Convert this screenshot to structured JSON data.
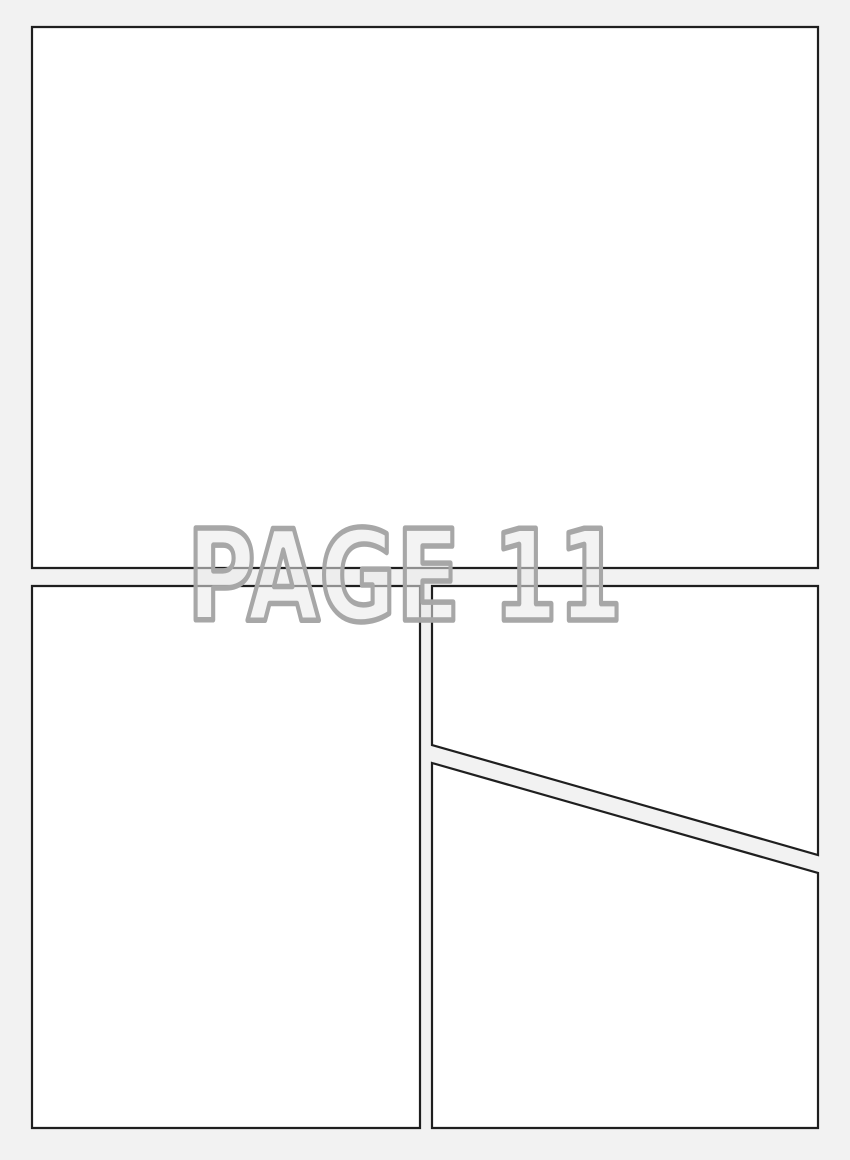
{
  "page_label": {
    "text": "PAGE 11"
  },
  "colors": {
    "page-bg": "#f2f2f2",
    "panel-fill": "#ffffff",
    "panel-border": "#1f1f1f",
    "label-outline": "#a7a7a7",
    "label-fill": "#e9e9e9"
  },
  "panels": [
    {
      "name": "top-full-width-panel",
      "points": "32,27 818,27 818,568 32,568"
    },
    {
      "name": "bottom-left-panel",
      "points": "32,586 420,586 420,1128 32,1128"
    },
    {
      "name": "right-upper-panel",
      "points": "432,586 818,586 818,855 432,745"
    },
    {
      "name": "right-lower-panel",
      "points": "432,763 818,873 818,1128 432,1128"
    }
  ]
}
